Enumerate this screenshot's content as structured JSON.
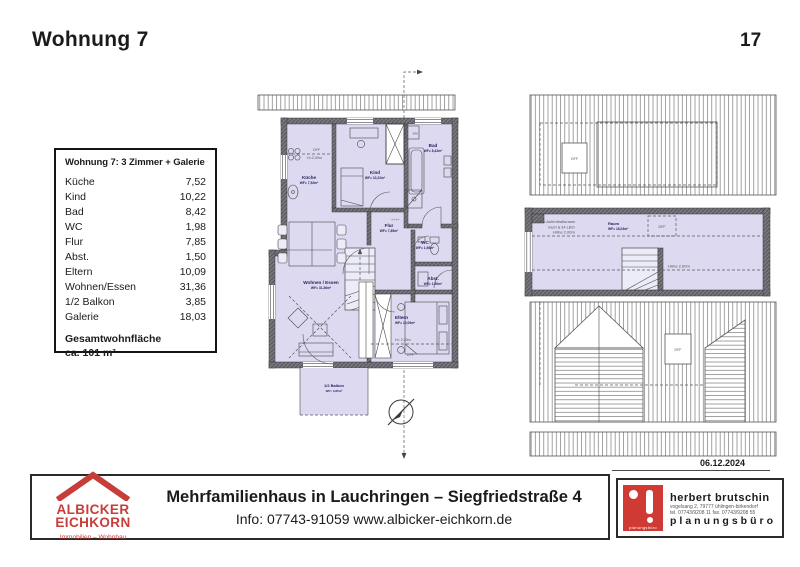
{
  "page": {
    "title": "Wohnung 7",
    "page_number": "17",
    "date": "06.12.2024"
  },
  "area_table": {
    "title": "Wohnung 7: 3 Zimmer + Galerie",
    "rows": [
      {
        "label": "Küche",
        "value": "7,52"
      },
      {
        "label": "Kind",
        "value": "10,22"
      },
      {
        "label": "Bad",
        "value": "8,42"
      },
      {
        "label": "WC",
        "value": "1,98"
      },
      {
        "label": "Flur",
        "value": "7,85"
      },
      {
        "label": "Abst.",
        "value": "1,50"
      },
      {
        "label": "Eltern",
        "value": "10,09"
      },
      {
        "label": "Wohnen/Essen",
        "value": "31,36"
      },
      {
        "label": "1/2 Balkon",
        "value": "3,85"
      },
      {
        "label": "Galerie",
        "value": "18,03"
      }
    ],
    "total_label": "Gesamtwohnfläche",
    "total_value": "ca. 101 m²"
  },
  "main_plan": {
    "rooms": {
      "kueche": {
        "name": "Küche",
        "area": "WF= 7,52m²"
      },
      "kind": {
        "name": "Kind",
        "area": "WF= 10,22m²"
      },
      "bad": {
        "name": "Bad",
        "area": "WF= 8,42m²"
      },
      "wc": {
        "name": "WC",
        "area": "WF= 1,98m²"
      },
      "flur": {
        "name": "Flur",
        "area": "WF= 7,85m²"
      },
      "abst": {
        "name": "Abst.",
        "area": "WF= 1,50m²"
      },
      "eltern": {
        "name": "Eltern",
        "area": "WF= 10,09m²"
      },
      "wohnen": {
        "name": "Wohnen / Essen",
        "area": "WF= 31,36m²"
      },
      "balkon": {
        "name": "1/2 Balkon",
        "area": "WF= 3,85m²"
      }
    },
    "annotations": {
      "dff": "DFF",
      "h200_kueche": "H=2,00m",
      "h200_eltern": "H= 2,00m",
      "wm": "WM",
      "heater": "++++"
    }
  },
  "gallery_plan": {
    "note_line1": "kein Aufenthaltsraum",
    "note_line2": "nach § 34 LBO",
    "room_name": "Raum",
    "room_area": "WF= 18,03m²",
    "hoehe_left": "Höhe 2,00m",
    "hoehe_right": "Höhe 2,00m",
    "dff_top": "DFF",
    "dff_room": "DFF",
    "dff_roof": "DFF"
  },
  "footer": {
    "agency": {
      "name_line1": "ALBICKER",
      "name_line2": "EICHKORN",
      "tagline": "Immobilien – Wohnbau"
    },
    "project_title": "Mehrfamilienhaus in Lauchringen – Siegfriedstraße 4",
    "info_line": "Info: 07743-91059 www.albicker-eichkorn.de",
    "planner": {
      "name": "herbert  brutschin",
      "address": "vogelsang 2, 79777 ühlingen-birkendorf",
      "phone": "tel. 07743/9208 11  fax. 07743/9208 55",
      "type": "planungsbüro",
      "logo_text": "planungsbüro"
    }
  },
  "colors": {
    "room_fill": "#dcd9f0",
    "accent_red": "#c63d39",
    "wall_gray": "#75757c"
  }
}
